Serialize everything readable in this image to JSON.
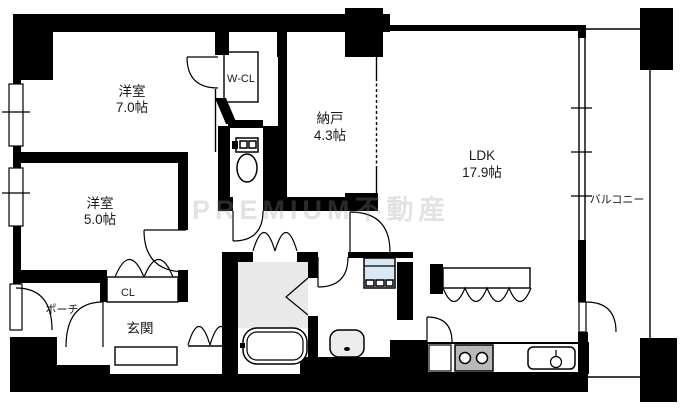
{
  "plan": {
    "title": "マンション間取り図",
    "watermark": "PREMIUM不動産",
    "rooms": {
      "western_room_7": {
        "label": "洋室",
        "size": "7.0帖"
      },
      "western_room_5": {
        "label": "洋室",
        "size": "5.0帖"
      },
      "storage_room": {
        "label": "納戸",
        "size": "4.3帖"
      },
      "ldk": {
        "label": "LDK",
        "size": "17.9帖"
      },
      "walk_in_closet": {
        "label": "W-CL"
      },
      "closet": {
        "label": "CL"
      },
      "entrance": {
        "label": "玄関"
      },
      "porch": {
        "label": "ポーチ"
      },
      "balcony": {
        "label": "バルコニー"
      }
    },
    "fixtures": [
      "toilet",
      "bathtub",
      "wash-basin",
      "washing-machine-pan",
      "gas-stove",
      "kitchen-sink",
      "kitchen-counter",
      "hanging-cabinet"
    ],
    "colors": {
      "wall": "#000000",
      "background": "#ffffff",
      "bath_floor": "#e9e9e9",
      "washer_pan": "#d9e7f5",
      "stove": "#b9b9b9",
      "basin": "#ececec",
      "watermark_gray": "#9a9a9a"
    }
  }
}
